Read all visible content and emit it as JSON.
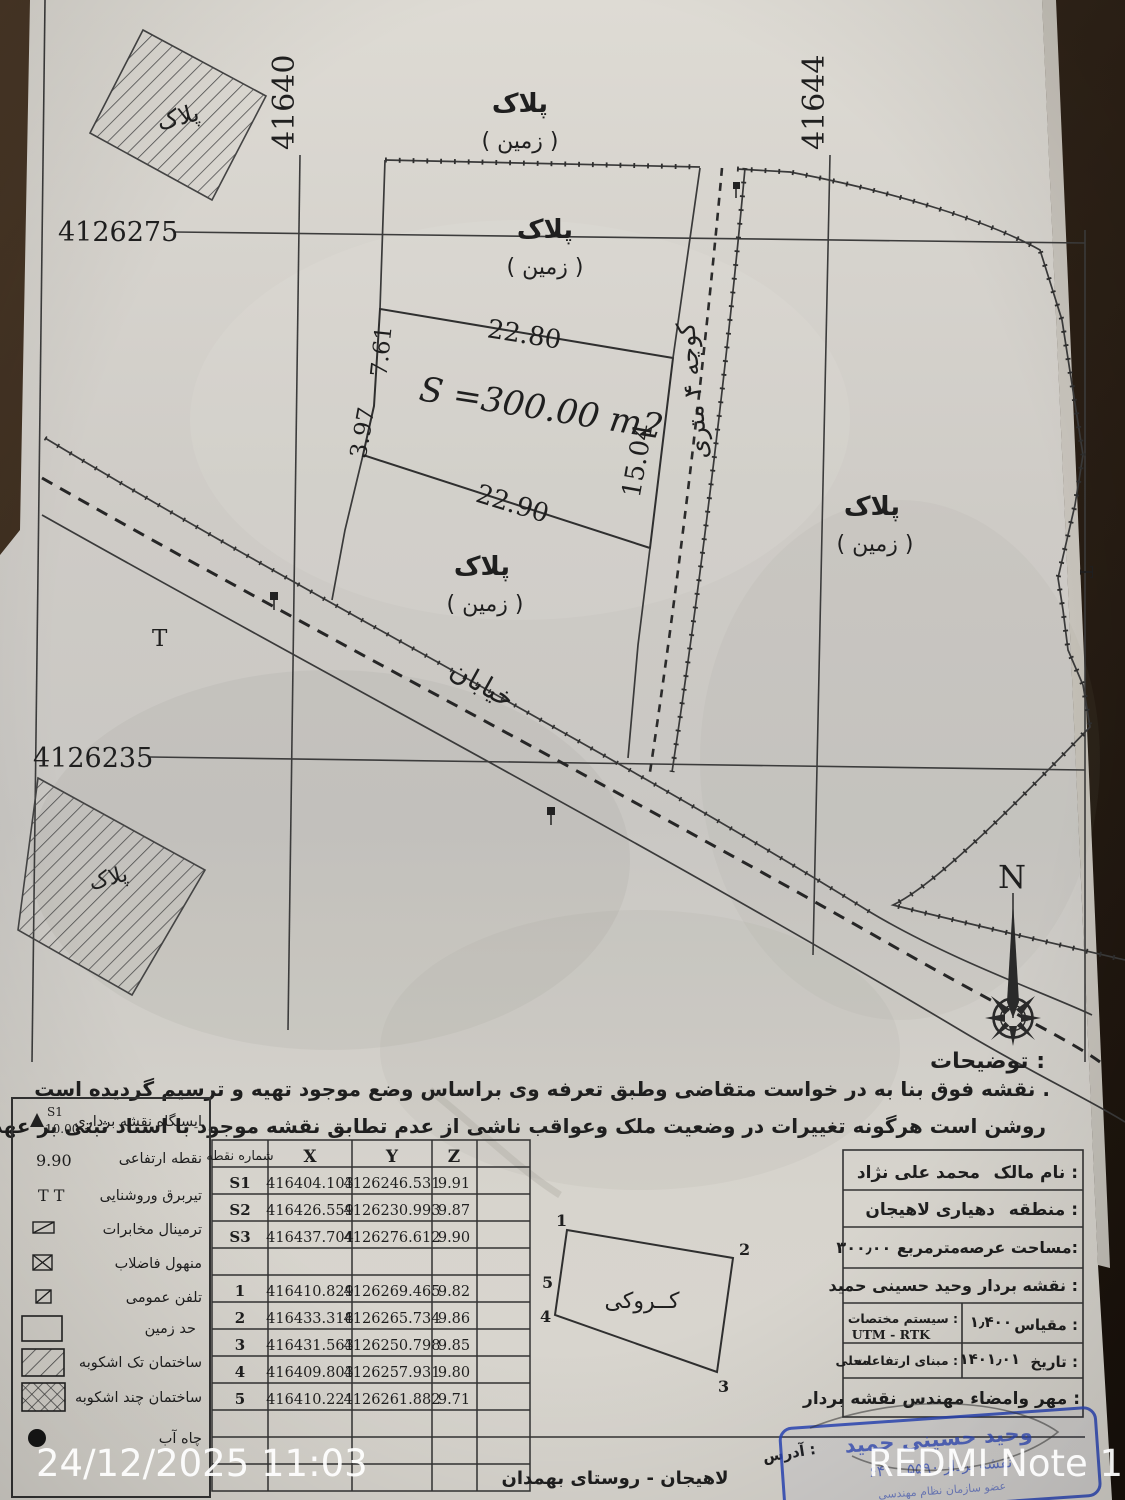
{
  "page": {
    "timestamp": "24/12/2025 11:03",
    "watermark": "REDMI Note 13"
  },
  "grid": {
    "v_left": "41640",
    "v_right": "41644",
    "h_top": "4126275",
    "h_bottom": "4126235"
  },
  "map": {
    "block_label": "پلاک",
    "block_sublabel": "( زمین )",
    "parcel": {
      "area": "S =300.00 m2",
      "top": "22.80",
      "bottom": "22.90",
      "right": "15.04",
      "left_upper": "7.61",
      "left_lower": "3.97"
    },
    "alley": "کوچه ۴ متری",
    "street": "خیابان",
    "north": "N",
    "pole": "T"
  },
  "notes": {
    "title": "توضیحات :",
    "line1": "نقشه فوق بنا به در خواست متقاضی وطبق تعرفه وی براساس وضع موجود تهیه و ترسیم گردیده است .",
    "line2": "روشن است هرگونه تغییرات در وضعیت ملک وعواقب ناشی از عدم تطابق نقشه موجود با اسناد ثبتی بر عهده کارفرما می باشد"
  },
  "legend": {
    "items": [
      {
        "label": "ایستگاه نقشه برداری",
        "sym_top": "S1",
        "sym_bottom": "10.00"
      },
      {
        "label": "نقطه ارتفاعی",
        "sym": "9.90"
      },
      {
        "label": "تیربرق وروشنایی",
        "sym": "T T"
      },
      {
        "label": "ترمینال مخابرات"
      },
      {
        "label": "منهول فاضلاب"
      },
      {
        "label": "تلفن عمومی"
      },
      {
        "label": "حد زمین"
      },
      {
        "label": "ساختمان تک اشکوبه"
      },
      {
        "label": "ساختمان چند اشکوبه"
      },
      {
        "label": "چاه آب"
      }
    ]
  },
  "coords": {
    "headers": {
      "point": "شماره نقطه",
      "x": "X",
      "y": "Y",
      "z": "Z"
    },
    "rows": [
      {
        "p": "S1",
        "x": "416404.103",
        "y": "4126246.531",
        "z": "9.91"
      },
      {
        "p": "S2",
        "x": "416426.559",
        "y": "4126230.993",
        "z": "9.87"
      },
      {
        "p": "S3",
        "x": "416437.704",
        "y": "4126276.612",
        "z": "9.90"
      },
      {
        "p": "1",
        "x": "416410.829",
        "y": "4126269.465",
        "z": "9.82"
      },
      {
        "p": "2",
        "x": "416433.318",
        "y": "4126265.734",
        "z": "9.86"
      },
      {
        "p": "3",
        "x": "416431.563",
        "y": "4126250.798",
        "z": "9.85"
      },
      {
        "p": "4",
        "x": "416409.803",
        "y": "4126257.931",
        "z": "9.80"
      },
      {
        "p": "5",
        "x": "416410.221",
        "y": "4126261.882",
        "z": "9.71"
      }
    ]
  },
  "sketch": {
    "title": "کــروکی",
    "c1": "1",
    "c2": "2",
    "c3": "3",
    "c4": "4",
    "c5": "5"
  },
  "info": {
    "owner_label": "نام مالک :",
    "owner": "محمد علی نژاد",
    "district_label": "منطقه :",
    "district": "دهیاری لاهیجان",
    "area_label": "مساحت عرصه:",
    "area": "۳۰۰٫۰۰ مترمربع",
    "surveyor_label": "نقشه بردار :",
    "surveyor": "وحید حسینی حمید",
    "scale_label": "مقیاس :",
    "scale": "۱٫۴۰۰",
    "crs_label": "سیستم مختصات :",
    "crs": "UTM - RTK",
    "date_label": "تاریخ :",
    "date": "۱۴۰۱٫۰۱",
    "datum_label": "مبنای ارتفاعات :",
    "datum": "محلی",
    "seal": "مهر وامضاء مهندس نقشه بردار :"
  },
  "address": {
    "label": "آدرس :",
    "value": "لاهیجان - روستای بهمدان"
  },
  "stamp": {
    "line1": "وحید حسینی حمید",
    "line2": "نقشه بردار ۵۵۹۰ ـ ۶۴۰",
    "line3": "عضو سازمان نظام مهندسی"
  }
}
